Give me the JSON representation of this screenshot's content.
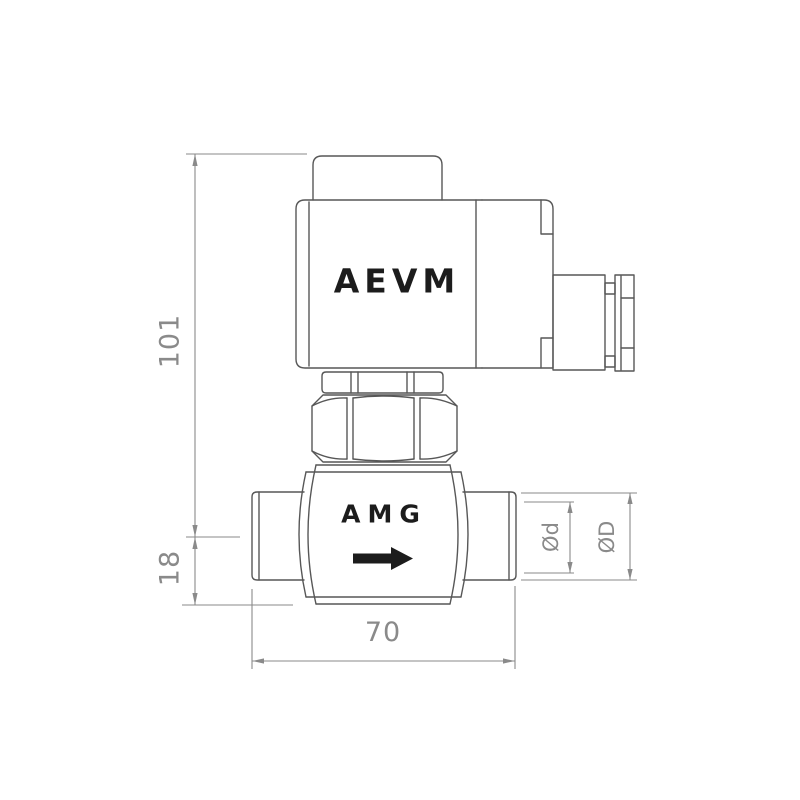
{
  "drawing": {
    "labels": {
      "coil": "AEVM",
      "body": "AMG"
    },
    "dimensions": {
      "overall_height": "101",
      "centerline_to_bottom": "18",
      "port_to_port_width": "70",
      "inner_diameter": "Ød",
      "outer_diameter": "ØD"
    },
    "icons": {
      "flow_direction": "right-arrow-icon"
    },
    "colors": {
      "background": "#ffffff",
      "outline": "#575757",
      "dimension": "#8a8a8a",
      "label": "#1c1c1c"
    }
  }
}
